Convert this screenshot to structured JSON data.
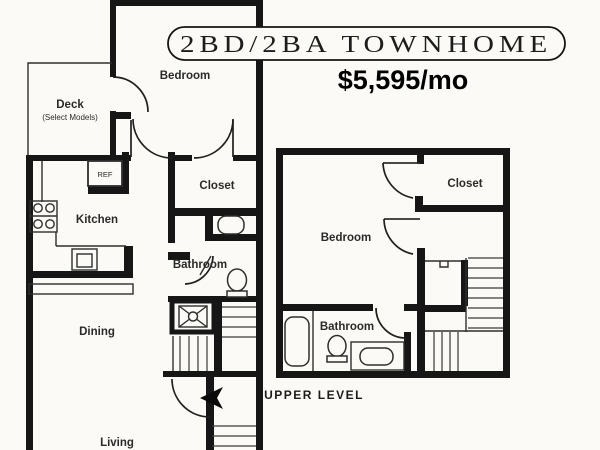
{
  "banner": {
    "title": "2BD/2BA TOWNHOME"
  },
  "pricing": {
    "monthly_rent": "$5,595/mo"
  },
  "lower_level": {
    "bedroom_label": "Bedroom",
    "deck_label": "Deck",
    "deck_note": "(Select Models)",
    "kitchen_label": "Kitchen",
    "refrigerator_label": "REF",
    "closet_label": "Closet",
    "bathroom_label": "Bathroom",
    "dining_label": "Dining",
    "living_label": "Living"
  },
  "upper_level": {
    "caption": "UPPER LEVEL",
    "bedroom_label": "Bedroom",
    "closet_label": "Closet",
    "bathroom_label": "Bathroom"
  },
  "colors": {
    "wall": "#161616",
    "line": "#2e2e2e",
    "background": "#fbfaf6",
    "text": "#1c1c1c"
  }
}
